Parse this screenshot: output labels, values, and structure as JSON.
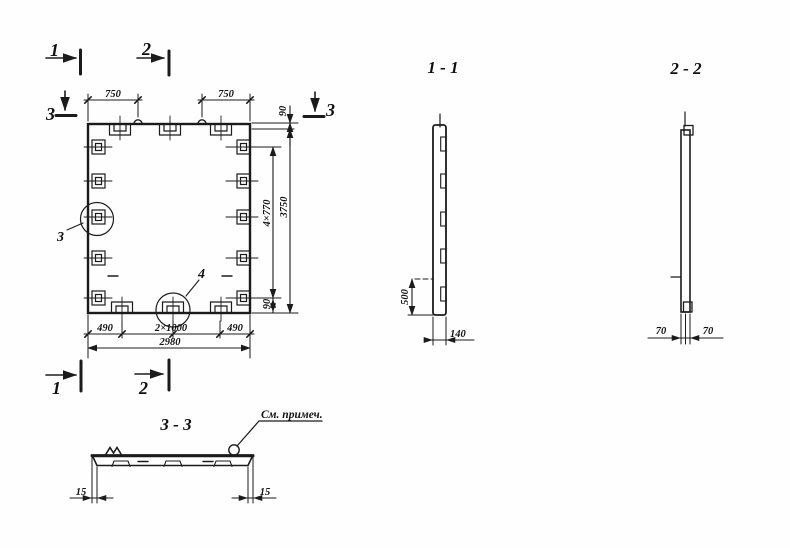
{
  "plan": {
    "markers": {
      "one": "1",
      "two": "2",
      "three": "3"
    },
    "details": {
      "three": "3",
      "four": "4"
    },
    "dims": {
      "left750": "750",
      "right750": "750",
      "top90": "90",
      "pitch": "4×770",
      "total_h": "3750",
      "bottom90": "90",
      "left490": "490",
      "mid2x1000": "2×1000",
      "right490": "490",
      "total_w": "2980"
    }
  },
  "sections": {
    "s11": {
      "title": "1 - 1",
      "d500": "500",
      "d140": "140"
    },
    "s22": {
      "title": "2 - 2",
      "d70a": "70",
      "d70b": "70"
    },
    "s33": {
      "title": "3 - 3",
      "d15a": "15",
      "d15b": "15",
      "note": "См. примеч."
    }
  }
}
